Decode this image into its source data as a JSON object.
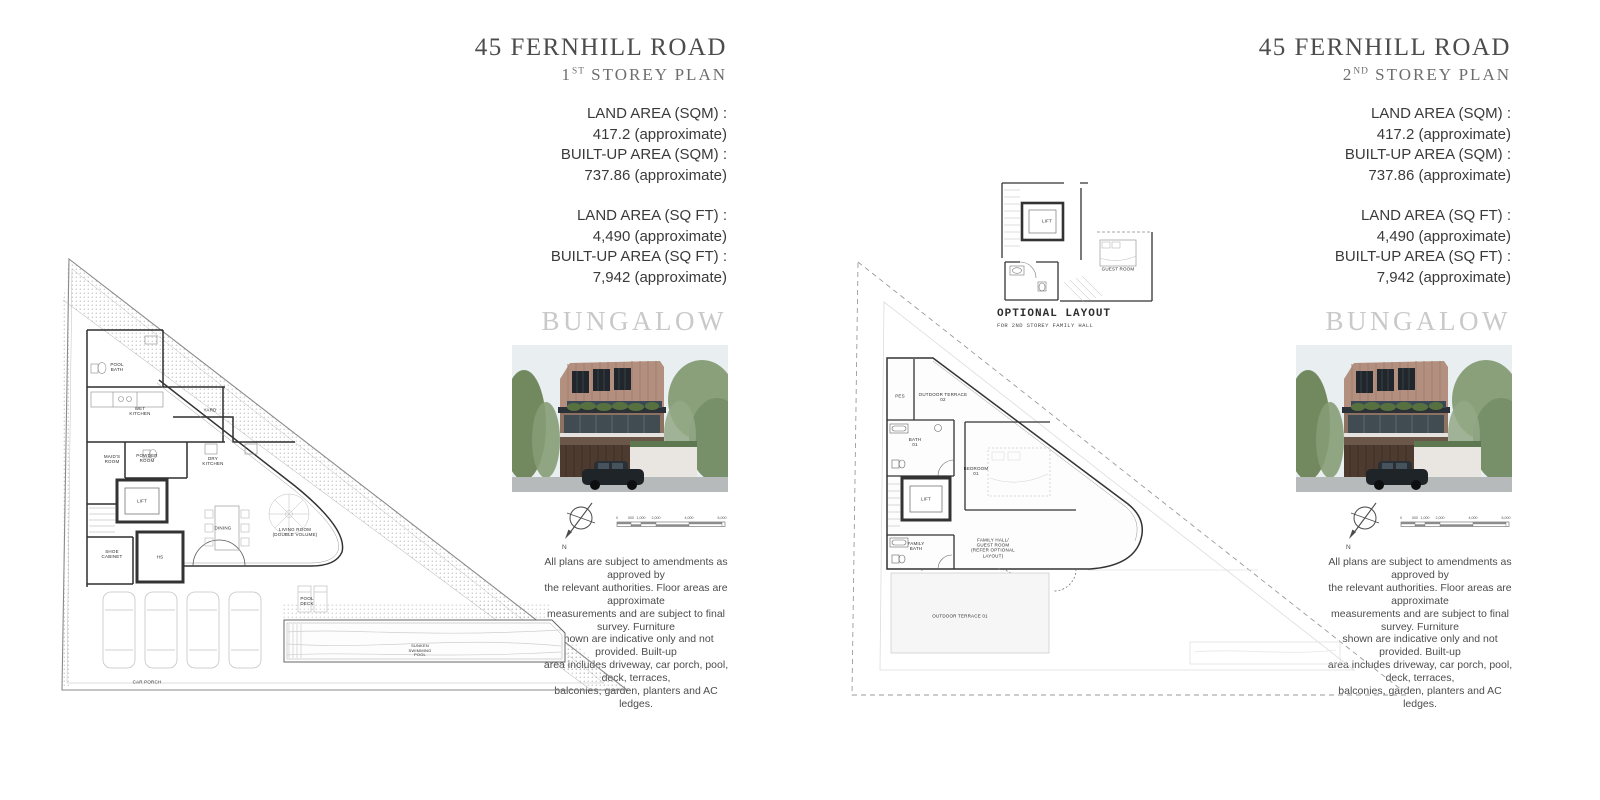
{
  "shared": {
    "bungalow_label": "BUNGALOW",
    "disclaimer": "All plans are subject to amendments as approved by\nthe relevant authorities. Floor areas are approximate\nmeasurements and are subject to final survey. Furniture\nshown are indicative only and not provided. Built-up\narea includes driveway, car porch, pool, deck, terraces,\nbalconies, garden, planters and AC ledges.",
    "areas": {
      "land_sqm_label": "LAND AREA (SQM) :",
      "land_sqm_value": "417.2 (approximate)",
      "built_sqm_label": "BUILT-UP AREA (SQM) :",
      "built_sqm_value": "737.86 (approximate)",
      "land_sqft_label": "LAND AREA (SQ FT) :",
      "land_sqft_value": "4,490 (approximate)",
      "built_sqft_label": "BUILT-UP AREA (SQ FT) :",
      "built_sqft_value": "7,942 (approximate)"
    },
    "compass_north_label": "N",
    "scale_labels": [
      "0",
      "500",
      "1,000",
      "2,000",
      "4,000",
      "6,000"
    ],
    "icons": {
      "compass": "compass-north-arrow",
      "scale_bar": "architectural-scale-bar"
    },
    "accent_colors": {
      "title_gray": "#4c4c4c",
      "bungalow_gray": "#c9c9c9",
      "plan_line": "#333333"
    }
  },
  "left_panel": {
    "title": "45 FERNHILL ROAD",
    "subtitle_num": "1",
    "subtitle_ord": "ST",
    "subtitle_text": " STOREY PLAN",
    "plan": {
      "pool_bath": "POOL\nBATH",
      "wet_kitchen": "WET\nKITCHEN",
      "yard": "YARD",
      "maids_room": "MAID'S\nROOM",
      "powder_room": "POWDER\nROOM",
      "lift": "LIFT",
      "dry_kitchen": "DRY\nKITCHEN",
      "shoe_cabinet": "SHOE\nCABINET",
      "hs": "HS",
      "dining": "DINING",
      "living_room": "LIVING ROOM\n(DOUBLE VOLUME)",
      "pool_deck": "POOL\nDECK",
      "car_porch": "CAR PORCH",
      "pool": "SUNKEN\nSWIMMING\nPOOL"
    }
  },
  "right_panel": {
    "title": "45 FERNHILL ROAD",
    "subtitle_num": "2",
    "subtitle_ord": "ND",
    "subtitle_text": " STOREY PLAN",
    "optional_layout": {
      "caption": "OPTIONAL LAYOUT",
      "subcaption": "FOR 2ND STOREY FAMILY HALL",
      "lift": "LIFT",
      "guest_room": "GUEST ROOM"
    },
    "plan": {
      "pes": "PES",
      "outdoor_terrace_02": "OUTDOOR TERRACE\n02",
      "bath_01": "BATH\n01",
      "lift": "LIFT",
      "bedroom_01": "BEDROOM\n01",
      "family_bath": "FAMILY\nBATH",
      "family_hall": "FAMILY HALL/\nGUEST ROOM\n(REFER OPTIONAL\nLAYOUT)",
      "outdoor_terrace_01": "OUTDOOR TERRACE 01"
    }
  }
}
